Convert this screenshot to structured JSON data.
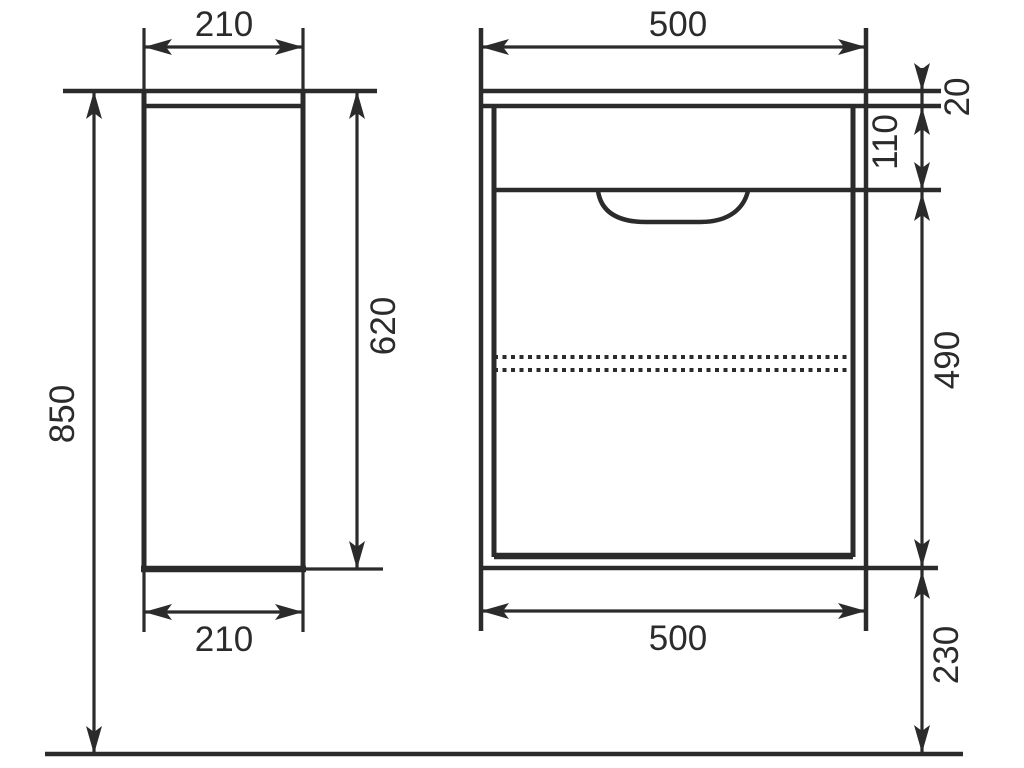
{
  "drawing": {
    "title": "Vanity cabinet dimensioned drawing, side and front views",
    "background_color": "#ffffff",
    "line_color": "#2b2b2b",
    "text_color": "#2b2b2b",
    "units": "mm",
    "views": {
      "side": {
        "name": "side view",
        "width_top": "210",
        "width_bottom": "210",
        "total_height": "850",
        "body_height": "620"
      },
      "front": {
        "name": "front view",
        "width_top": "500",
        "width_bottom": "500",
        "worktop_thickness": "20",
        "drawer_front_height": "110",
        "lower_body_height": "490",
        "floor_clearance": "230"
      }
    }
  }
}
